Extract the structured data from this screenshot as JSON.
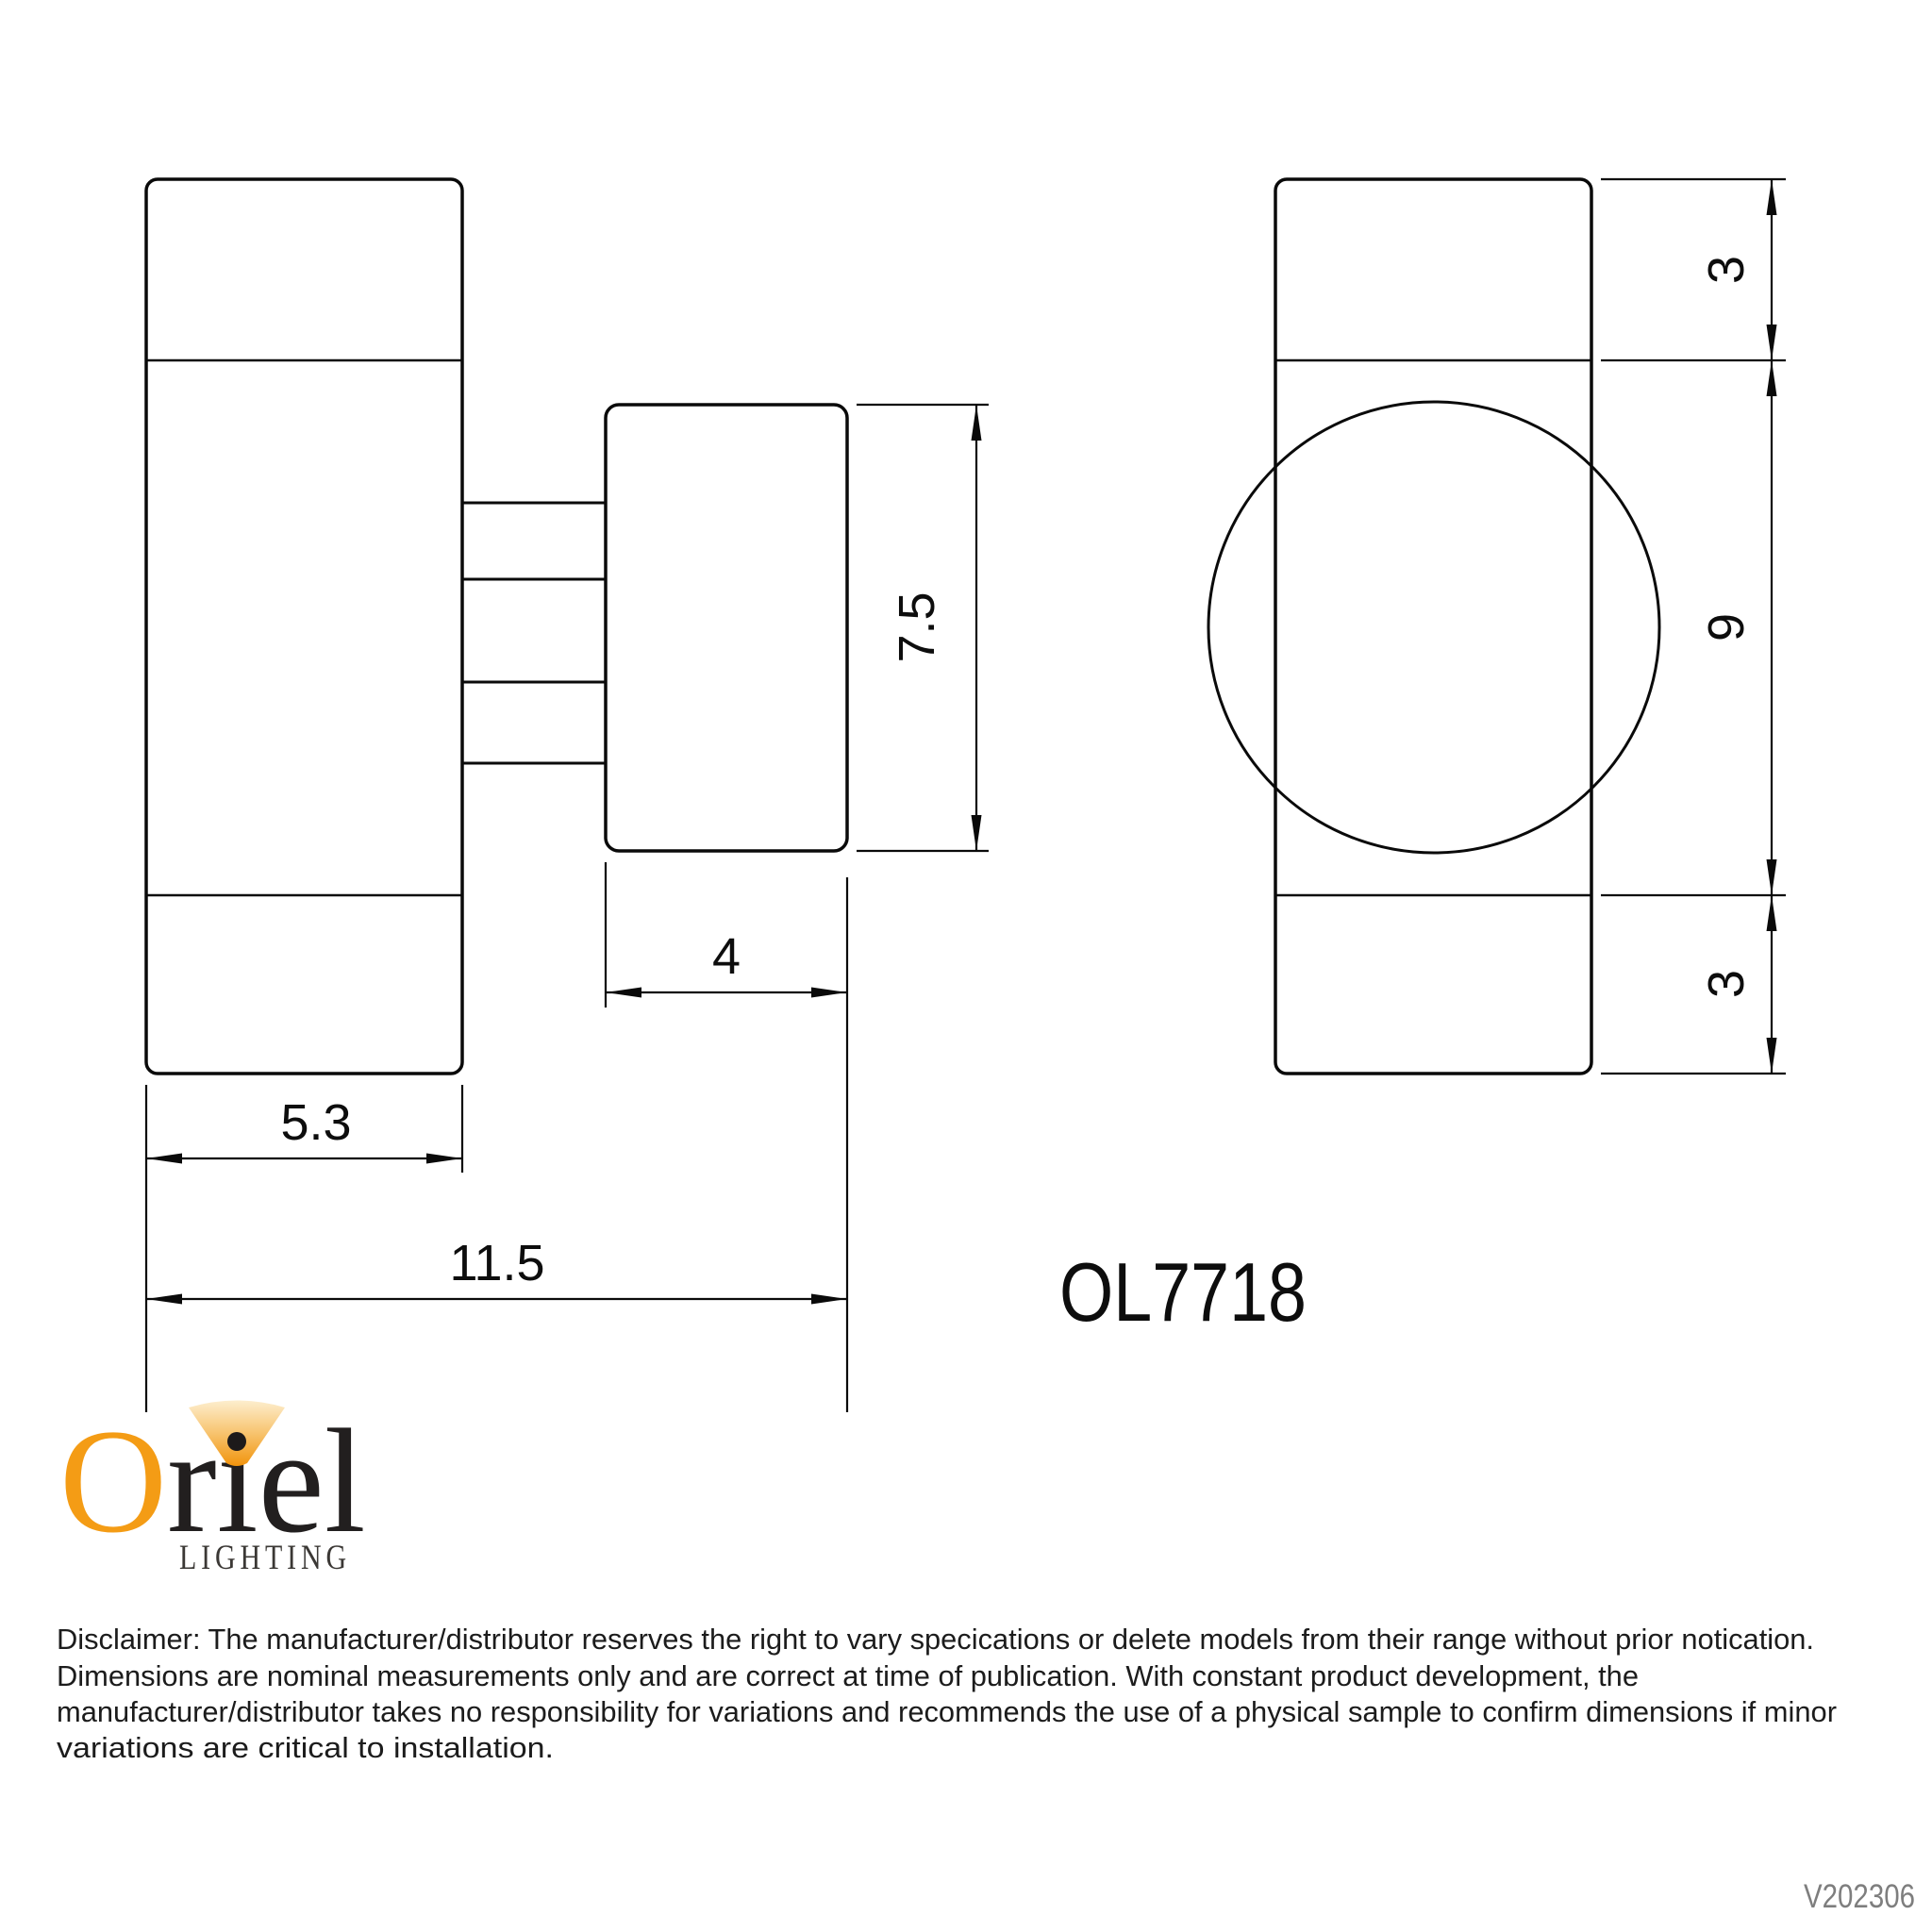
{
  "title_block": {
    "model": "OL7718",
    "version": "V202306"
  },
  "dimensions": {
    "front_width": "5.3",
    "overall_width": "11.5",
    "body_depth": "4",
    "body_height": "7.5",
    "top_section": "3",
    "mid_section": "9",
    "bottom_section": "3"
  },
  "logo": {
    "brand": "Oriel",
    "wordmark_o": "O",
    "wordmark_rest": "rıel",
    "tagline": "LIGHTING"
  },
  "disclaimer": {
    "line1": "Disclaimer: The manufacturer/distributor reserves the right to vary specications or delete models from their range without prior notication.",
    "line2": "Dimensions are nominal measurements only and are correct at time of publication. With constant product development, the",
    "line3": "manufacturer/distributor takes no responsibility for variations and recommends the use of a physical sample to confirm dimensions if minor",
    "line4": "variations are critical to installation."
  },
  "colors": {
    "line": "#0a0a0a",
    "logo_orange": "#F49C15",
    "logo_dark": "#221f1f",
    "version_gray": "#7e7e7e"
  }
}
